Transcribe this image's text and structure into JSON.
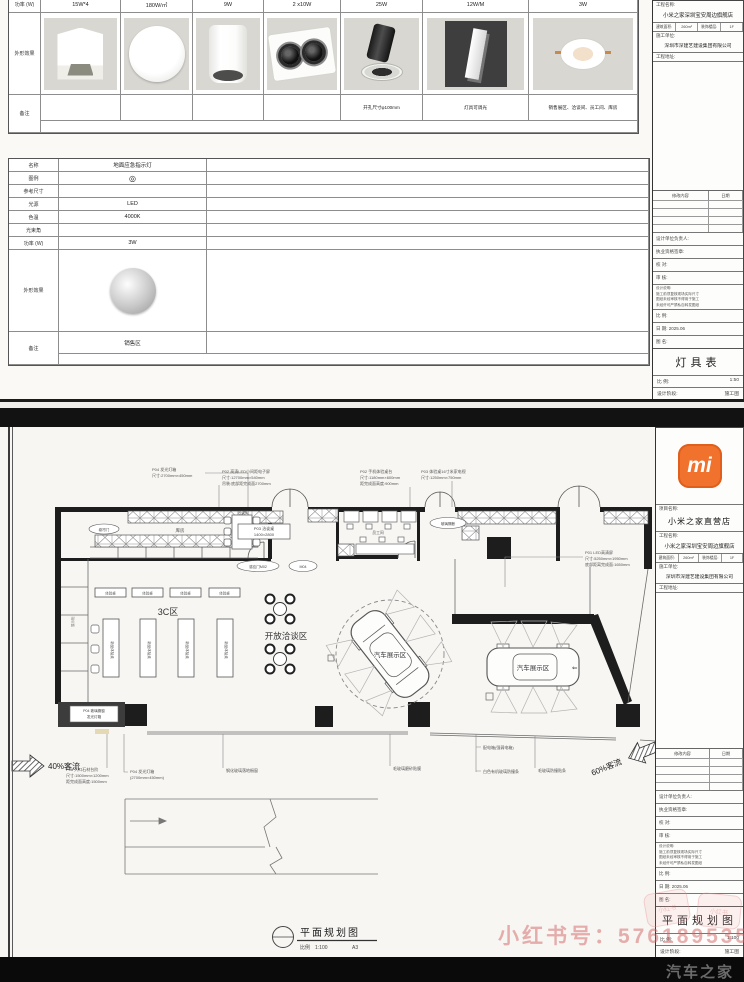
{
  "colors": {
    "xiaomi_orange": "#f0722c",
    "paper": "#faf9f6",
    "watermark_red": "#d26464",
    "black_bar": "#0a0a0a"
  },
  "logo": {
    "text": "mi"
  },
  "s1": {
    "fixtures": {
      "power_label": "功率 (W)",
      "appearance_label": "外形效果",
      "remark_label": "备注",
      "powers": [
        "15W*4",
        "180W/㎡",
        "9W",
        "2 x10W",
        "25W",
        "12W/M",
        "3W"
      ],
      "remarks": [
        "",
        "",
        "",
        "",
        "开孔尺寸φ100mm",
        "灯具可调光",
        "销售展区、洽谈间、员工间、库房"
      ]
    },
    "spec": {
      "rows": [
        {
          "label": "名称",
          "value": "地面应急指示灯"
        },
        {
          "label": "图例",
          "value": "◎"
        },
        {
          "label": "参考尺寸",
          "value": ""
        },
        {
          "label": "光源",
          "value": "LED"
        },
        {
          "label": "色温",
          "value": "4000K"
        },
        {
          "label": "光束角",
          "value": ""
        },
        {
          "label": "功率 (W)",
          "value": "3W"
        }
      ],
      "appearance_label": "外形效果",
      "remark_label": "备注",
      "remark_value": "销售区"
    }
  },
  "tb1": {
    "project_label": "工程名称:",
    "project": "小米之家深圳宝安周边旗舰店",
    "area_label": "建筑面积:",
    "area": "260m²",
    "floor_label": "装饰楼层:",
    "floor": "1F",
    "builder_label": "施工单位:",
    "builder": "深圳市深建艺建设集团有限公司",
    "addr_label": "工程地址:",
    "rev_content": "修改内容",
    "rev_date": "日期",
    "r1": "设计单位负责人:",
    "r2": "执业资格签章:",
    "r3": "校  对:",
    "r4": "审  核:",
    "note_title": "设计说明:",
    "n1": "施工前须复核现场实际尺寸",
    "n2": "图纸未经审核不得用于施工",
    "n3": "未经许可严禁私自转发图纸",
    "scale_label": "比  例:",
    "date_label": "日  期:",
    "date": "2025.06",
    "name_label": "图  名:",
    "drawing": "灯具表",
    "b1l": "比  例:",
    "b1v": "1:50",
    "b2l": "设计阶段:",
    "b2v": "施工图"
  },
  "tb2": {
    "store_label": "项目名称:",
    "store": "小米之家直营店",
    "project_label": "工程名称:",
    "project": "小米之家深圳宝安周边旗舰店",
    "area_label": "建筑面积:",
    "area": "260m²",
    "floor_label": "装饰楼层:",
    "floor": "1F",
    "builder_label": "施工单位:",
    "builder": "深圳市深建艺建设集团有限公司",
    "addr_label": "工程地址:",
    "rev_content": "修改内容",
    "rev_date": "日期",
    "r1": "设计单位负责人:",
    "r2": "执业资格签章:",
    "r3": "校  对:",
    "r4": "审  核:",
    "note_title": "设计说明:",
    "n1": "施工前须复核现场实际尺寸",
    "n2": "图纸未经审核不得用于施工",
    "n3": "未经许可严禁私自转发图纸",
    "scale_label": "比  例:",
    "date_label": "日  期:",
    "date": "2025.06",
    "name_label": "图  名:",
    "drawing": "平面规划图",
    "b1l": "比  例:",
    "b1v": "1:100",
    "b2l": "设计阶段:",
    "b2v": "施工图"
  },
  "plan": {
    "rooms": {
      "storage": "库房",
      "meeting": "洽谈间",
      "staff": "员工间"
    },
    "zones": {
      "threec": "3C区",
      "lounge": "开放洽谈区",
      "car1": "汽车展示区",
      "car2": "汽车展示区",
      "car2_arrow": "⇐"
    },
    "flows": {
      "left": "40%客流",
      "right": "60%客流"
    },
    "tags": {
      "table_tag": "体验桌",
      "table_inner": "新品体验桌",
      "meeting1": "P03 洽谈桌",
      "meeting2": "1400×2800",
      "left_strip": "展示柜",
      "shutter": "卷帘门",
      "entrance1": "感应门M02",
      "entrance2": "M04",
      "utility_door": "玻璃隔断",
      "sb1": "P04 玻璃橱窗",
      "sb2": "发光灯箱"
    },
    "callouts": {
      "c1a": "P04 发光灯箱",
      "c1b": "尺寸:2700mm×450mm",
      "c2a": "P02 高清LED小间距电子屏",
      "c2b": "尺寸:12700mm×540mm",
      "c2c": "吊装:底部距完成面2700mm",
      "c3a": "P02 手机体验桌台",
      "c3b": "尺寸:1180mm×600mm",
      "c3c": "距完成面高度:900mm",
      "c4a": "P03 体验桌16寸米家电视",
      "c4b": "尺寸:1250mm×750mm",
      "c5a": "P01 LED高清屏",
      "c5b": "尺寸:5250mm×1950mm",
      "c5c": "底部距离完成面:1650mm",
      "a1": "P06 入口石材台阶",
      "a2": "尺寸:1500mm×1200mm",
      "a3": "距完成面高度:1500mm",
      "b1": "P04 发光灯箱",
      "b2": "(2700mm×450mm)",
      "d1": "钢化玻璃落地橱窗",
      "d2": "毛玻璃磨砂贴膜",
      "e1": "配电箱(强弱电箱)",
      "e2": "白色有机玻璃防撞条",
      "f1": "毛玻璃防撞贴条"
    },
    "title": {
      "name": "平面规划图",
      "scale_label": "比例",
      "scale": "1:100",
      "size": "A3"
    }
  },
  "watermarks": {
    "xhs": "小红书号：576189535",
    "xhs_logo": "小红书",
    "autohome": "汽车之家"
  }
}
